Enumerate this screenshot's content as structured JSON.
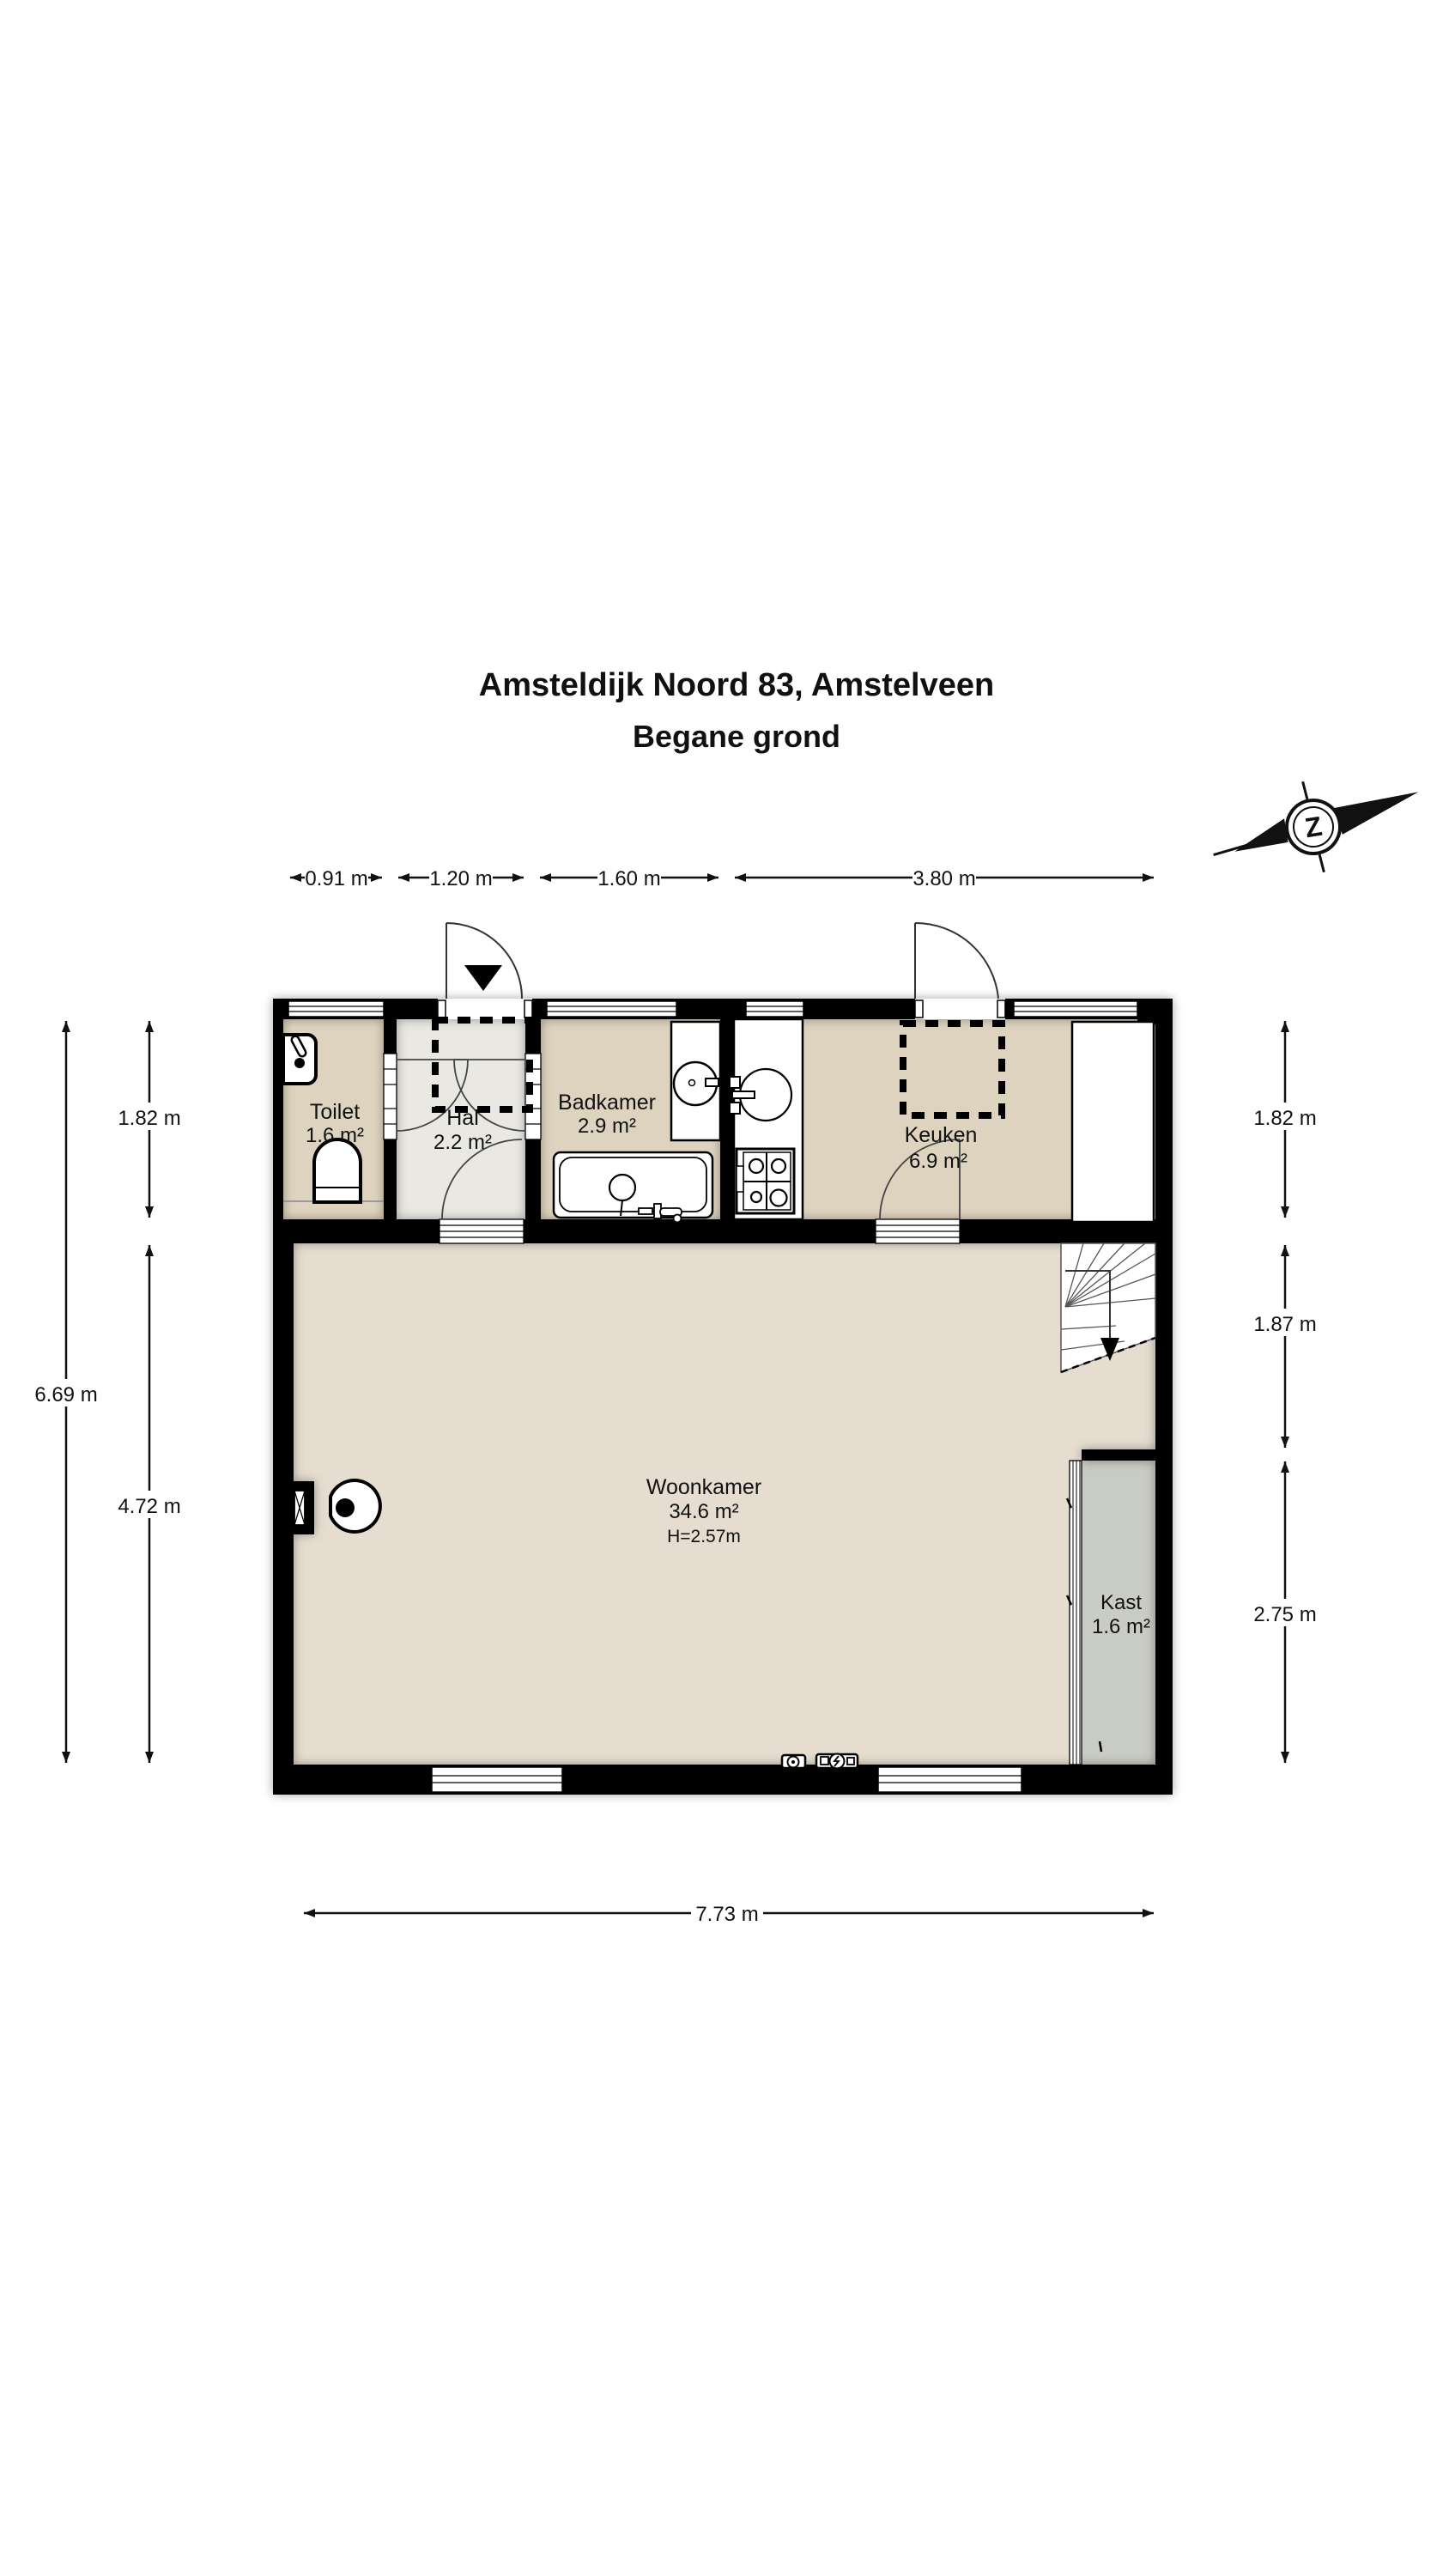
{
  "title": {
    "address": "Amsteldijk Noord 83, Amstelveen",
    "floor": "Begane grond"
  },
  "compass": {
    "letter": "Z"
  },
  "rooms": {
    "toilet": {
      "name": "Toilet",
      "area": "1.6 m²"
    },
    "hal": {
      "name": "Hal",
      "area": "2.2 m²"
    },
    "badkamer": {
      "name": "Badkamer",
      "area": "2.9 m²"
    },
    "keuken": {
      "name": "Keuken",
      "area": "6.9 m²"
    },
    "woonkamer": {
      "name": "Woonkamer",
      "area": "34.6 m²",
      "ceiling_height": "H=2.57m"
    },
    "kast": {
      "name": "Kast",
      "area": "1.6 m²"
    }
  },
  "dimensions": {
    "top": {
      "d1": "0.91 m",
      "d2": "1.20 m",
      "d3": "1.60 m",
      "d4": "3.80 m"
    },
    "left": {
      "total": "6.69 m",
      "upper": "1.82 m",
      "lower": "4.72 m"
    },
    "right": {
      "upper": "1.82 m",
      "middle": "1.87 m",
      "lower": "2.75 m"
    },
    "bottom": {
      "total": "7.73 m"
    }
  },
  "colors": {
    "wall": "#000000",
    "floor_room": "#ded3bf",
    "floor_hall": "#eae8e2",
    "floor_living": "#e6ddd0",
    "floor_closet": "#c9ccc3",
    "fixture": "#ffffff",
    "line": "#111111"
  }
}
